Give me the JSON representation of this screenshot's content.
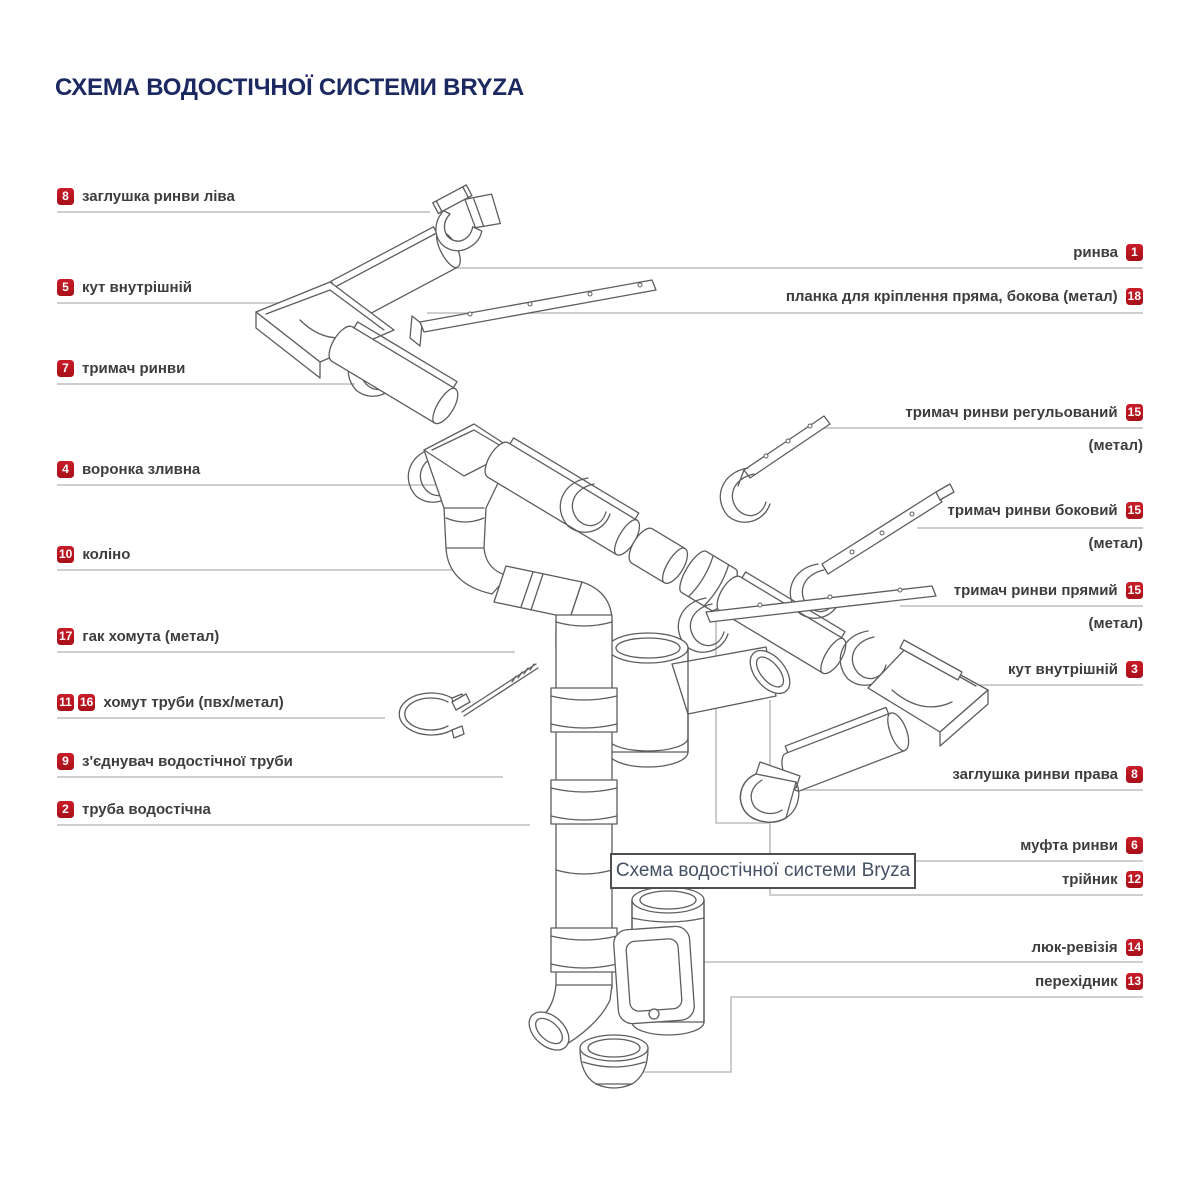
{
  "title": "СХЕМА ВОДОСТІЧНОЇ СИСТЕМИ BRYZA",
  "caption": "Схема водостічної системи Bryza",
  "colors": {
    "badge_red": "#bb1723",
    "title_navy": "#1c2961",
    "label_text": "#3d3d3d",
    "leader_gray": "#c7c7c7",
    "drawing_line": "#5c5d5f"
  },
  "labels_left": [
    {
      "nums": [
        "8"
      ],
      "text": "заглушка ринви ліва"
    },
    {
      "nums": [
        "5"
      ],
      "text": "кут внутрішній"
    },
    {
      "nums": [
        "7"
      ],
      "text": "тримач ринви"
    },
    {
      "nums": [
        "4"
      ],
      "text": "воронка зливна"
    },
    {
      "nums": [
        "10"
      ],
      "text": "коліно"
    },
    {
      "nums": [
        "17"
      ],
      "text": "гак хомута (метал)"
    },
    {
      "nums": [
        "11",
        "16"
      ],
      "text": "хомут труби (пвх/метал)"
    },
    {
      "nums": [
        "9"
      ],
      "text": "з'єднувач водостічної труби"
    },
    {
      "nums": [
        "2"
      ],
      "text": "труба водостічна"
    }
  ],
  "labels_right": [
    {
      "text": "ринва",
      "nums": [
        "1"
      ],
      "sub": ""
    },
    {
      "text": "планка для кріплення пряма, бокова (метал)",
      "nums": [
        "18"
      ],
      "sub": ""
    },
    {
      "text": "тримач ринви регульований",
      "nums": [
        "15"
      ],
      "sub": "(метал)"
    },
    {
      "text": "тримач ринви боковий",
      "nums": [
        "15"
      ],
      "sub": "(метал)"
    },
    {
      "text": "тримач ринви прямий",
      "nums": [
        "15"
      ],
      "sub": "(метал)"
    },
    {
      "text": "кут внутрішній",
      "nums": [
        "3"
      ],
      "sub": ""
    },
    {
      "text": "заглушка ринви права",
      "nums": [
        "8"
      ],
      "sub": ""
    },
    {
      "text": "муфта ринви",
      "nums": [
        "6"
      ],
      "sub": ""
    },
    {
      "text": "трійник",
      "nums": [
        "12"
      ],
      "sub": ""
    },
    {
      "text": "люк-ревізія",
      "nums": [
        "14"
      ],
      "sub": ""
    },
    {
      "text": "перехідник",
      "nums": [
        "13"
      ],
      "sub": ""
    }
  ]
}
